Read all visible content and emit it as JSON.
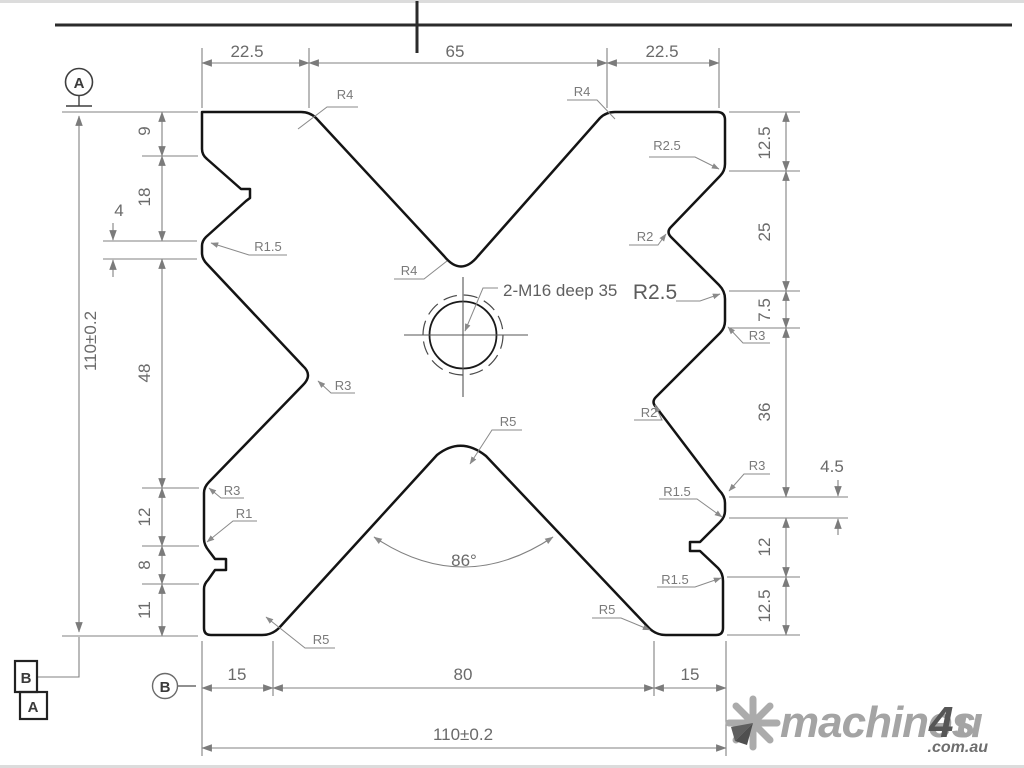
{
  "drawing": {
    "hole_note": "2-M16 deep 35",
    "angle_label": "86°",
    "dims": {
      "top_left": "22.5",
      "top_mid": "65",
      "top_right": "22.5",
      "left_9": "9",
      "left_18": "18",
      "left_4": "4",
      "left_height": "110±0.2",
      "left_48": "48",
      "left_12": "12",
      "left_8": "8",
      "left_11": "11",
      "right_125_top": "12.5",
      "right_25": "25",
      "right_75": "7.5",
      "right_36": "36",
      "right_45": "4.5",
      "right_12": "12",
      "right_125_bot": "12.5",
      "bottom_15_left": "15",
      "bottom_80": "80",
      "bottom_15_right": "15",
      "bottom_width": "110±0.2"
    },
    "radius_labels": [
      "R4",
      "R4",
      "R4",
      "R2.5",
      "R2",
      "R2.5",
      "R3",
      "R2",
      "R3",
      "R1.5",
      "R1.5",
      "R3",
      "R1.5",
      "R3",
      "R1",
      "R5",
      "R5",
      "R5"
    ],
    "datums": {
      "top_circle": "A",
      "square_top": "B",
      "square_bottom": "A",
      "bottom_circle": "B"
    }
  },
  "watermark": {
    "brand_gray": "machines",
    "brand_accent": "4",
    "brand_tail": "u",
    "domain": ".com.au"
  },
  "colors": {
    "outline": "#141414",
    "dim_lines": "#818181",
    "dim_text": "#6a6a6a",
    "watermark_gray": "#a4a4a4",
    "watermark_dark": "#565656"
  }
}
